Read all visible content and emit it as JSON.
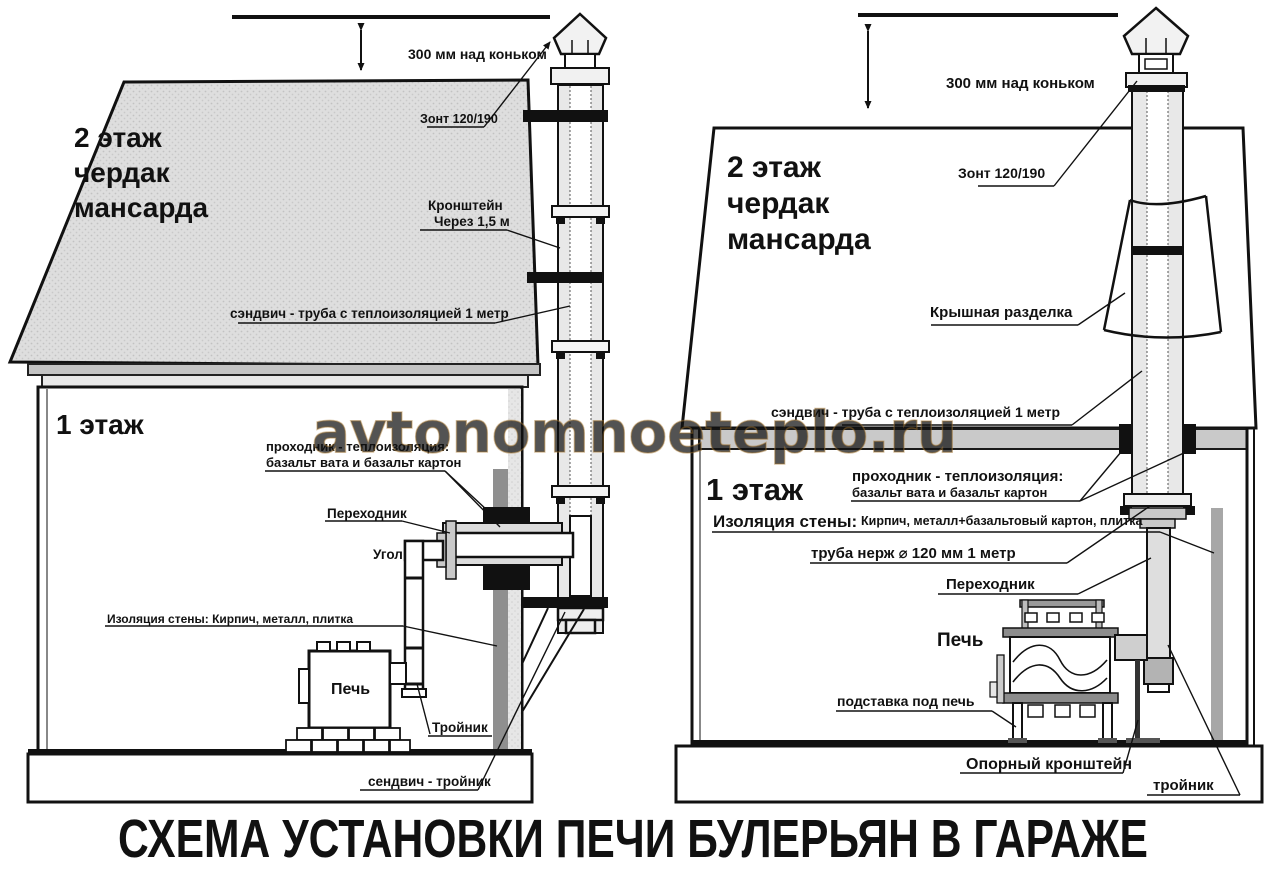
{
  "watermark": "avtonomnoeteplo.ru",
  "caption": "СХЕМА УСТАНОВКИ ПЕЧИ БУЛЕРЬЯН В ГАРАЖЕ",
  "colors": {
    "line": "#111111",
    "roof_gray": "#dcdcdc",
    "pipe_gray": "#e8e8e8",
    "watermark_gold": "#e4b96b",
    "caption_color": "#3b4043"
  },
  "left": {
    "floor2": [
      "2 этаж",
      "чердак",
      "мансарда"
    ],
    "floor1": "1 этаж",
    "ridge_clearance": "300 мм над коньком",
    "cap": "Зонт 120/190",
    "bracket_line1": "Кронштейн",
    "bracket_line2": "Через 1,5 м",
    "sandwich_pipe": "сэндвич - труба с теплоизоляцией 1 метр",
    "pass_line1": "проходник - теплоизоляция:",
    "pass_line2": "базальт вата и базальт картон",
    "adapter": "Переходник",
    "elbow": "Угол",
    "wall_insulation": "Изоляция стены: Кирпич, металл, плитка",
    "stove": "Печь",
    "tee": "Тройник",
    "sandwich_tee": "сендвич - тройник"
  },
  "right": {
    "floor2": [
      "2 этаж",
      "чердак",
      "мансарда"
    ],
    "floor1": "1 этаж",
    "ridge_clearance": "300 мм над коньком",
    "cap": "Зонт 120/190",
    "roof_flashing": "Крышная разделка",
    "sandwich_pipe": "сэндвич - труба с теплоизоляцией 1 метр",
    "pass_line1": "проходник - теплоизоляция:",
    "pass_line2": "базальт вата и базальт картон",
    "wall_insulation_title": "Изоляция стены:",
    "wall_insulation_rest": "Кирпич, металл+базальтовый картон, плитка",
    "steel_pipe": "труба нерж ⌀ 120 мм 1 метр",
    "adapter": "Переходник",
    "stove": "Печь",
    "stove_stand": "подставка под печь",
    "support_bracket": "Опорный кронштейн",
    "tee": "тройник"
  }
}
